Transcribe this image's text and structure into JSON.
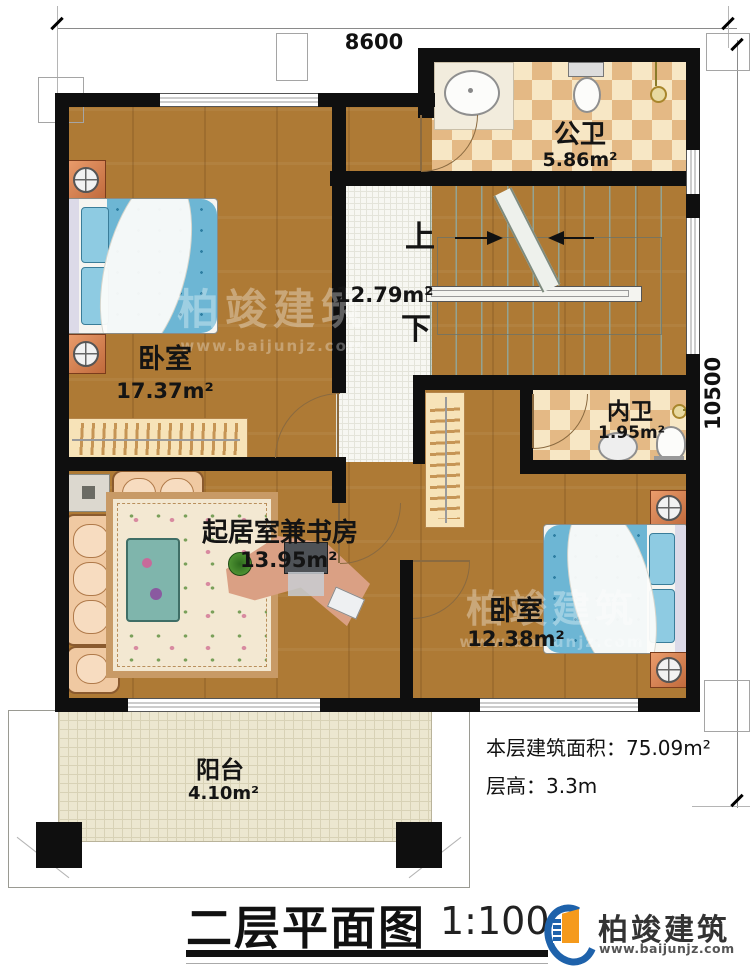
{
  "plan": {
    "dimensions": {
      "top": "8600",
      "right": "10500"
    },
    "rooms": {
      "bedroom1": {
        "name": "卧室",
        "area": "17.37m²"
      },
      "public_bath": {
        "name": "公卫",
        "area": "5.86m²"
      },
      "stair_hall": {
        "area": "12.79m²",
        "up": "上",
        "down": "下"
      },
      "inner_bath": {
        "name": "内卫",
        "area": "1.95m²"
      },
      "living_study": {
        "name": "起居室兼书房",
        "area": "13.95m²"
      },
      "bedroom2": {
        "name": "卧室",
        "area": "12.38m²"
      },
      "balcony": {
        "name": "阳台",
        "area": "4.10m²"
      }
    },
    "fixtures": [
      "bed",
      "nightstand",
      "wardrobe",
      "sofa",
      "rug",
      "coffee-table",
      "side-table",
      "desk",
      "monitor",
      "keyboard",
      "plant",
      "toilet",
      "sink",
      "shower-head",
      "stairs",
      "handrail",
      "door",
      "window"
    ]
  },
  "info": {
    "floor_area": "本层建筑面积：75.09m²",
    "floor_height": "层高：3.3m"
  },
  "titlebar": {
    "title": "二层平面图",
    "scale": "1:100"
  },
  "brand": {
    "name": "柏竣建筑",
    "website": "www.baijunjz.com"
  },
  "watermark": {
    "name": "柏竣建筑",
    "website": "www.baijunjz.com"
  },
  "colors": {
    "wall": "#0f0f0f",
    "wood": "#ae7a35",
    "tile_check": "#dd9e63",
    "stair": "#cdd7cb",
    "bed": "#6db6d4",
    "brand_blue": "#1e62ab",
    "brand_orange": "#f59a1c"
  }
}
